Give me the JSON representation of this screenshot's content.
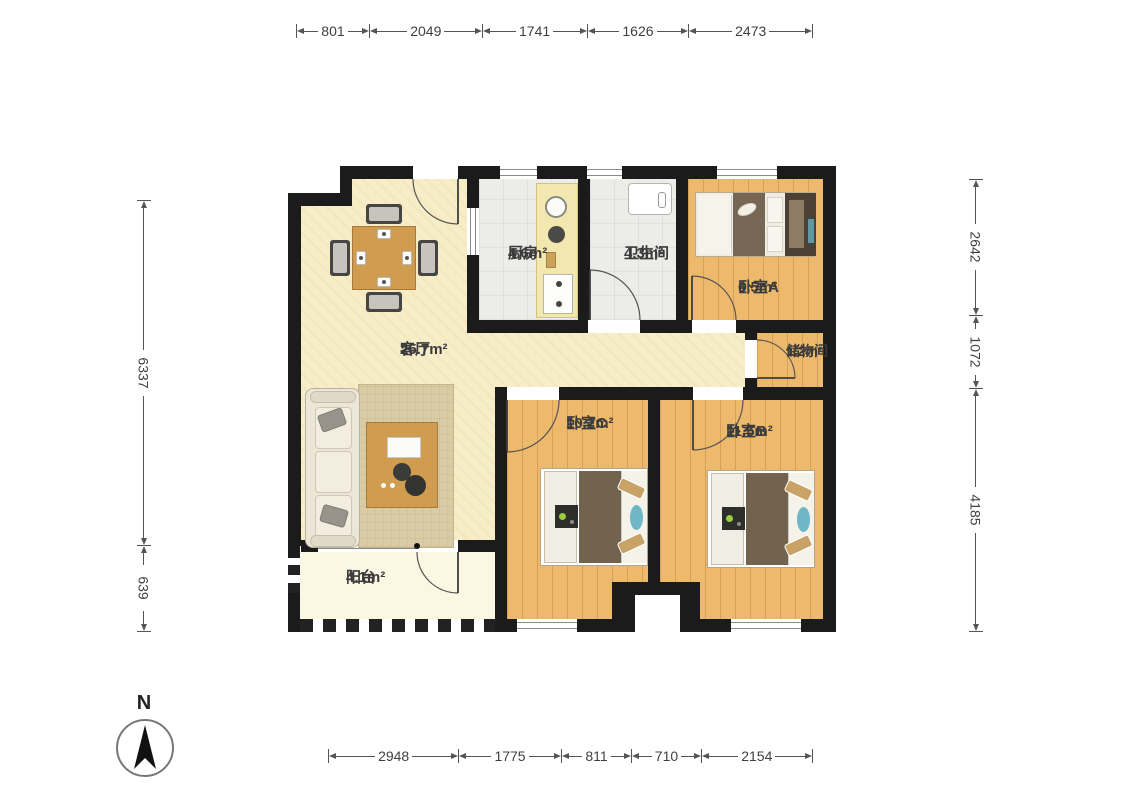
{
  "plan_title": "3-room apartment floor plan",
  "compass": {
    "label": "N"
  },
  "dimensions": {
    "top": [
      "801",
      "2049",
      "1741",
      "1626",
      "2473"
    ],
    "bottom": [
      "2948",
      "1775",
      "811",
      "710",
      "2154"
    ],
    "left": [
      "6337",
      "639"
    ],
    "right": [
      "2642",
      "1072",
      "4185"
    ]
  },
  "rooms": {
    "living": {
      "name": "客厅",
      "area": "25.7m²"
    },
    "kitchen": {
      "name": "厨房",
      "area": "4.6m²"
    },
    "bathroom": {
      "name": "卫生间",
      "area": "4.3m²"
    },
    "bedroomA": {
      "name": "卧室A",
      "area": "6.5m²"
    },
    "storage": {
      "name": "储物间",
      "area": "1.2m²"
    },
    "bedroomC": {
      "name": "卧室C",
      "area": "10.2m²"
    },
    "bedroomB": {
      "name": "卧室B",
      "area": "11.5m²"
    },
    "balcony": {
      "name": "阳台",
      "area": "4.1m²"
    }
  },
  "colors": {
    "wall": "#1b1b1b",
    "living_floor": "#f7edc9",
    "tile_floor": "#ecece9",
    "wood_floor": "#edb96d",
    "balcony_floor": "#fbf7e3",
    "accent_teal": "#6fb7c4",
    "furniture_wood": "#d09c4f"
  }
}
